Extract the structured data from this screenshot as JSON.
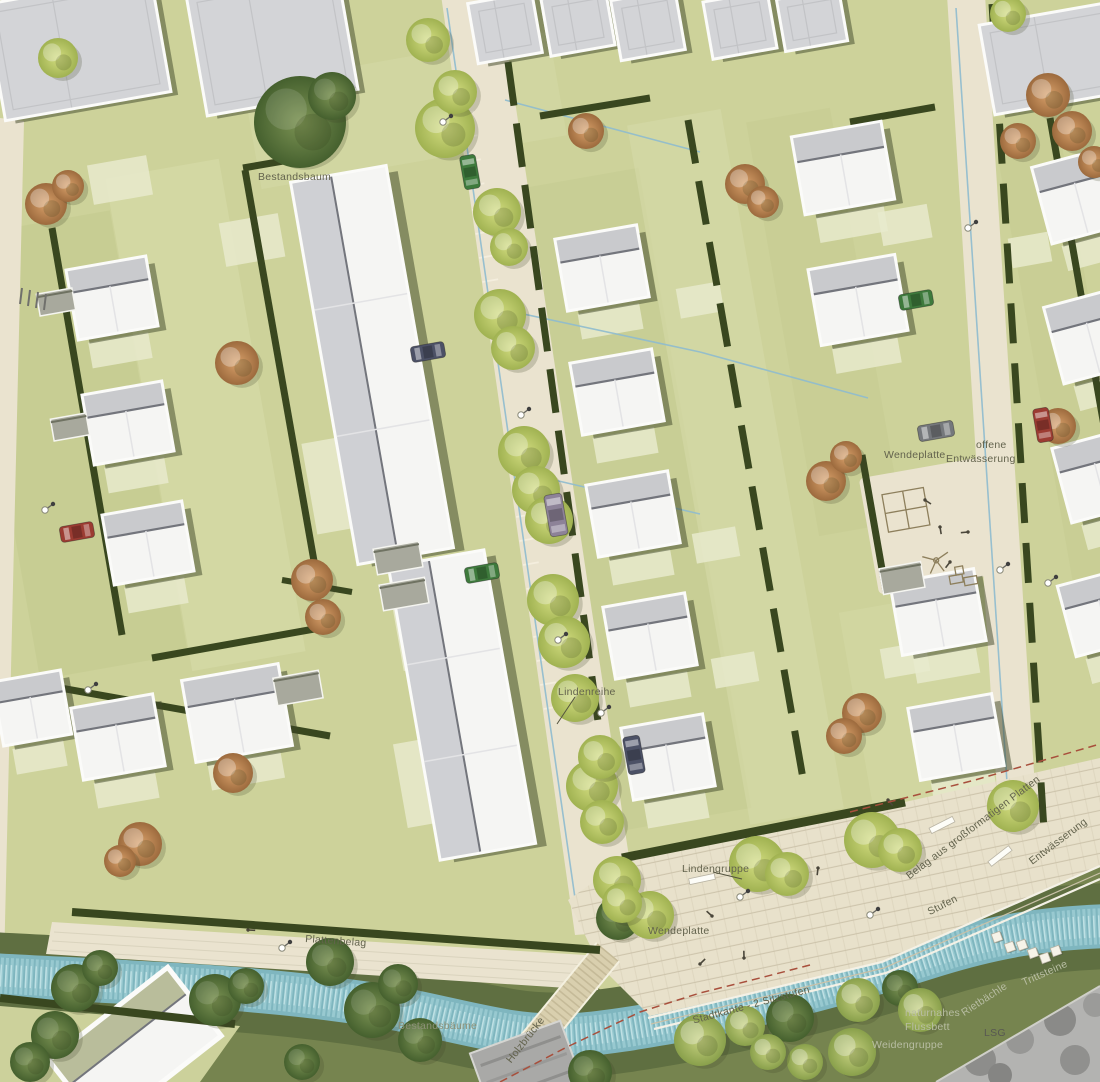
{
  "labels": {
    "bestandsbaum": "Bestandsbaum",
    "wendeplatte_ost": "Wendeplatte",
    "offene": "offene",
    "entwaesserung_ost": "Entwässerung",
    "lindenreihe": "Lindenreihe",
    "lindengruppe": "Lindengruppe",
    "wendeplatte_sued": "Wendeplatte",
    "plattenbelag": "Plattenbelag",
    "bestandsbaeume": "Bestandsbäume",
    "holzbruecke": "Holzbrücke",
    "stadtkante": "Stadtkante - 2 Sitzstufen",
    "belag": "Belag aus großformatigen Platten",
    "entwaesserung_sued": "Entwässerung",
    "stufen": "Stufen",
    "rietbaechle": "Rietbächle",
    "naturnahes": "naturnahes",
    "flussbett": "Flussbett",
    "lsg": "LSG",
    "weidengruppe": "Weidengruppe",
    "trittsteine": "Trittsteine"
  },
  "colors": {
    "base_green": "#cdd29a",
    "green_dark": "#c1c88c",
    "green_light": "#d8dcab",
    "pale_pad": "#e7eacd",
    "street": "#eae3cf",
    "plaza": "#e8e1cb",
    "plaza_joint": "#cbc2a9",
    "hedge": "#39471f",
    "river": "#7fb6bf",
    "river_light": "#9ccdd2",
    "river_pale": "#c8e6e8",
    "meadow": "#76844f",
    "meadow_dark": "#5f6f41",
    "roof_white": "#f5f5f3",
    "roof_gray": "#c9cacd",
    "roof_ridge": "#73757c",
    "gray_building": "#d3d4d7",
    "garage": "#a8a99d",
    "shadow": "#3e4628",
    "tree_lime": "#b8c568",
    "tree_autumn": "#c18a5a",
    "tree_dark": "#5d7440",
    "tree_willow": "#9fae5e",
    "drainage": "#8fbccf",
    "lsg_dash": "#a84f3c",
    "photo_gray": "#b3b3b1",
    "car_green": "#3e7a3c",
    "car_red": "#9c3c32",
    "car_dark": "#4c5166",
    "car_van": "#8d8298",
    "car_gray": "#75787c"
  },
  "features": {
    "houses": [
      [
        112,
        298,
        78,
        68
      ],
      [
        128,
        423,
        78,
        68
      ],
      [
        148,
        543,
        78,
        68
      ],
      [
        32,
        708,
        66,
        62
      ],
      [
        118,
        737,
        80,
        70
      ],
      [
        237,
        713,
        95,
        80
      ],
      [
        602,
        268,
        80,
        70
      ],
      [
        617,
        392,
        80,
        70
      ],
      [
        633,
        514,
        80,
        70
      ],
      [
        650,
        636,
        80,
        70
      ],
      [
        668,
        757,
        80,
        70
      ],
      [
        843,
        168,
        88,
        76
      ],
      [
        858,
        300,
        85,
        74
      ],
      [
        938,
        612,
        82,
        70
      ],
      [
        956,
        737,
        82,
        70
      ],
      [
        1078,
        196,
        72,
        76,
        -15
      ],
      [
        1090,
        336,
        72,
        76,
        -15
      ],
      [
        1098,
        476,
        72,
        74,
        -15
      ],
      [
        1102,
        612,
        70,
        70,
        -15
      ]
    ],
    "slabs": [
      [
        372,
        365,
        94,
        385
      ],
      [
        462,
        705,
        94,
        295
      ]
    ],
    "gray_buildings": [
      [
        78,
        48,
        165,
        115
      ],
      [
        272,
        42,
        150,
        120
      ],
      [
        505,
        28,
        62,
        58
      ],
      [
        578,
        22,
        62,
        55
      ],
      [
        648,
        25,
        62,
        58
      ],
      [
        740,
        25,
        62,
        55
      ],
      [
        812,
        20,
        60,
        50
      ],
      [
        1055,
        58,
        135,
        88
      ]
    ],
    "garages": [
      [
        56,
        302,
        36,
        22
      ],
      [
        70,
        427,
        36,
        22
      ],
      [
        398,
        558,
        46,
        26
      ],
      [
        404,
        594,
        46,
        26
      ],
      [
        298,
        688,
        46,
        28
      ],
      [
        902,
        578,
        42,
        26
      ]
    ],
    "pads": [
      [
        330,
        255,
        48,
        92
      ],
      [
        333,
        485,
        48,
        92
      ],
      [
        420,
        625,
        48,
        85
      ],
      [
        424,
        782,
        48,
        85
      ],
      [
        252,
        240,
        60,
        44
      ],
      [
        120,
        180,
        60,
        40
      ],
      [
        700,
        300,
        44,
        30
      ],
      [
        716,
        545,
        44,
        30
      ],
      [
        735,
        670,
        44,
        30
      ],
      [
        905,
        225,
        50,
        34
      ],
      [
        1030,
        250,
        40,
        30
      ],
      [
        300,
        128,
        54,
        36
      ],
      [
        905,
        660,
        46,
        30
      ]
    ],
    "hedges": [
      [
        52,
        228,
        122,
        635
      ],
      [
        245,
        170,
        317,
        578
      ],
      [
        152,
        658,
        320,
        628
      ],
      [
        38,
        684,
        330,
        736
      ],
      [
        508,
        62,
        606,
        780,
        7,
        "44 18"
      ],
      [
        688,
        120,
        805,
        790,
        7,
        "44 18"
      ],
      [
        862,
        455,
        886,
        592
      ],
      [
        992,
        4,
        1044,
        830,
        7,
        "40 20"
      ],
      [
        1050,
        118,
        1110,
        460
      ],
      [
        243,
        168,
        330,
        153
      ],
      [
        540,
        116,
        650,
        98
      ],
      [
        850,
        122,
        935,
        107
      ],
      [
        622,
        858,
        905,
        802,
        9
      ],
      [
        0,
        998,
        235,
        1024,
        8
      ],
      [
        72,
        912,
        600,
        950,
        8
      ],
      [
        282,
        580,
        352,
        592,
        6
      ]
    ],
    "drainage": [
      [
        447,
        8,
        575,
        898
      ],
      [
        956,
        8,
        1010,
        828
      ],
      [
        505,
        310,
        700,
        352
      ],
      [
        520,
        472,
        700,
        514
      ],
      [
        700,
        352,
        868,
        398
      ],
      [
        1006,
        792,
        1048,
        898
      ],
      [
        505,
        100,
        700,
        152
      ]
    ],
    "trees": [
      [
        "dark",
        300,
        122,
        46
      ],
      [
        "dark",
        332,
        96,
        24
      ],
      [
        "dark",
        75,
        988,
        24
      ],
      [
        "dark",
        100,
        968,
        18
      ],
      [
        "dark",
        215,
        1000,
        26
      ],
      [
        "dark",
        246,
        986,
        18
      ],
      [
        "dark",
        330,
        962,
        24
      ],
      [
        "dark",
        372,
        1010,
        28
      ],
      [
        "dark",
        398,
        984,
        20
      ],
      [
        "dark",
        420,
        1040,
        22
      ],
      [
        "dark",
        55,
        1035,
        24
      ],
      [
        "dark",
        30,
        1062,
        20
      ],
      [
        "dark",
        618,
        918,
        22
      ],
      [
        "dark",
        590,
        1072,
        22
      ],
      [
        "dark",
        790,
        1018,
        24
      ],
      [
        "dark",
        900,
        988,
        18
      ],
      [
        "dark",
        302,
        1062,
        18
      ],
      [
        "lime",
        445,
        128,
        30
      ],
      [
        "lime",
        455,
        92,
        22
      ],
      [
        "lime",
        500,
        315,
        26
      ],
      [
        "lime",
        513,
        348,
        22
      ],
      [
        "lime",
        524,
        452,
        26
      ],
      [
        "lime",
        536,
        490,
        24
      ],
      [
        "lime",
        553,
        600,
        26
      ],
      [
        "lime",
        564,
        642,
        26
      ],
      [
        "lime",
        575,
        698,
        24
      ],
      [
        "lime",
        592,
        786,
        26
      ],
      [
        "lime",
        602,
        822,
        22
      ],
      [
        "lime",
        617,
        880,
        24
      ],
      [
        "lime",
        497,
        212,
        24
      ],
      [
        "lime",
        509,
        247,
        19
      ],
      [
        "lime",
        549,
        520,
        24
      ],
      [
        "lime",
        600,
        757,
        22
      ],
      [
        "lime",
        58,
        58,
        20
      ],
      [
        "lime",
        428,
        40,
        22
      ],
      [
        "lime",
        650,
        915,
        24
      ],
      [
        "lime",
        622,
        903,
        20
      ],
      [
        "lime",
        757,
        864,
        28
      ],
      [
        "lime",
        787,
        874,
        22
      ],
      [
        "lime",
        872,
        840,
        28
      ],
      [
        "lime",
        900,
        850,
        22
      ],
      [
        "lime",
        1013,
        806,
        26
      ],
      [
        "lime",
        1008,
        14,
        18
      ],
      [
        "autumn",
        46,
        204,
        21
      ],
      [
        "autumn",
        68,
        186,
        16
      ],
      [
        "autumn",
        237,
        363,
        22
      ],
      [
        "autumn",
        312,
        580,
        21
      ],
      [
        "autumn",
        323,
        617,
        18
      ],
      [
        "autumn",
        140,
        844,
        22
      ],
      [
        "autumn",
        120,
        861,
        16
      ],
      [
        "autumn",
        233,
        773,
        20
      ],
      [
        "autumn",
        586,
        131,
        18
      ],
      [
        "autumn",
        745,
        184,
        20
      ],
      [
        "autumn",
        763,
        202,
        16
      ],
      [
        "autumn",
        826,
        481,
        20
      ],
      [
        "autumn",
        846,
        457,
        16
      ],
      [
        "autumn",
        862,
        713,
        20
      ],
      [
        "autumn",
        844,
        736,
        18
      ],
      [
        "autumn",
        1048,
        95,
        22
      ],
      [
        "autumn",
        1072,
        131,
        20
      ],
      [
        "autumn",
        1018,
        141,
        18
      ],
      [
        "autumn",
        1094,
        162,
        16
      ],
      [
        "autumn",
        1058,
        426,
        18
      ],
      [
        "willow",
        700,
        1040,
        26
      ],
      [
        "willow",
        745,
        1026,
        20
      ],
      [
        "willow",
        858,
        1000,
        22
      ],
      [
        "willow",
        920,
        1010,
        22
      ],
      [
        "willow",
        852,
        1052,
        24
      ],
      [
        "willow",
        805,
        1062,
        18
      ],
      [
        "willow",
        768,
        1052,
        18
      ]
    ],
    "cars": [
      [
        470,
        172,
        80,
        "car_green",
        34,
        16
      ],
      [
        428,
        352,
        -10,
        "car_dark",
        34,
        16
      ],
      [
        556,
        515,
        80,
        "car_van",
        42,
        18
      ],
      [
        482,
        573,
        -10,
        "car_green",
        34,
        16
      ],
      [
        634,
        755,
        80,
        "car_dark",
        38,
        17
      ],
      [
        77,
        532,
        -10,
        "car_red",
        34,
        16
      ],
      [
        916,
        300,
        -10,
        "car_green",
        34,
        16
      ],
      [
        936,
        431,
        -10,
        "car_gray",
        36,
        16
      ],
      [
        1043,
        425,
        80,
        "car_red",
        34,
        16
      ]
    ],
    "lamps": [
      [
        443,
        122
      ],
      [
        521,
        415
      ],
      [
        558,
        640
      ],
      [
        601,
        713
      ],
      [
        45,
        510
      ],
      [
        88,
        690
      ],
      [
        968,
        228
      ],
      [
        1000,
        570
      ],
      [
        282,
        948
      ],
      [
        740,
        897
      ],
      [
        870,
        915
      ],
      [
        1048,
        583
      ]
    ],
    "people": [
      [
        925,
        500
      ],
      [
        940,
        527
      ],
      [
        950,
        562
      ],
      [
        968,
        532
      ],
      [
        712,
        916
      ],
      [
        744,
        958
      ],
      [
        700,
        964
      ],
      [
        248,
        930
      ],
      [
        888,
        800
      ],
      [
        818,
        868
      ]
    ],
    "benches": [
      [
        702,
        879,
        -12
      ],
      [
        942,
        825,
        -27
      ],
      [
        1000,
        856,
        -38
      ]
    ],
    "stepping_stones": [
      [
        997,
        937
      ],
      [
        1010,
        947
      ],
      [
        1022,
        945
      ],
      [
        1033,
        953
      ],
      [
        1045,
        958
      ],
      [
        1056,
        951
      ]
    ]
  }
}
